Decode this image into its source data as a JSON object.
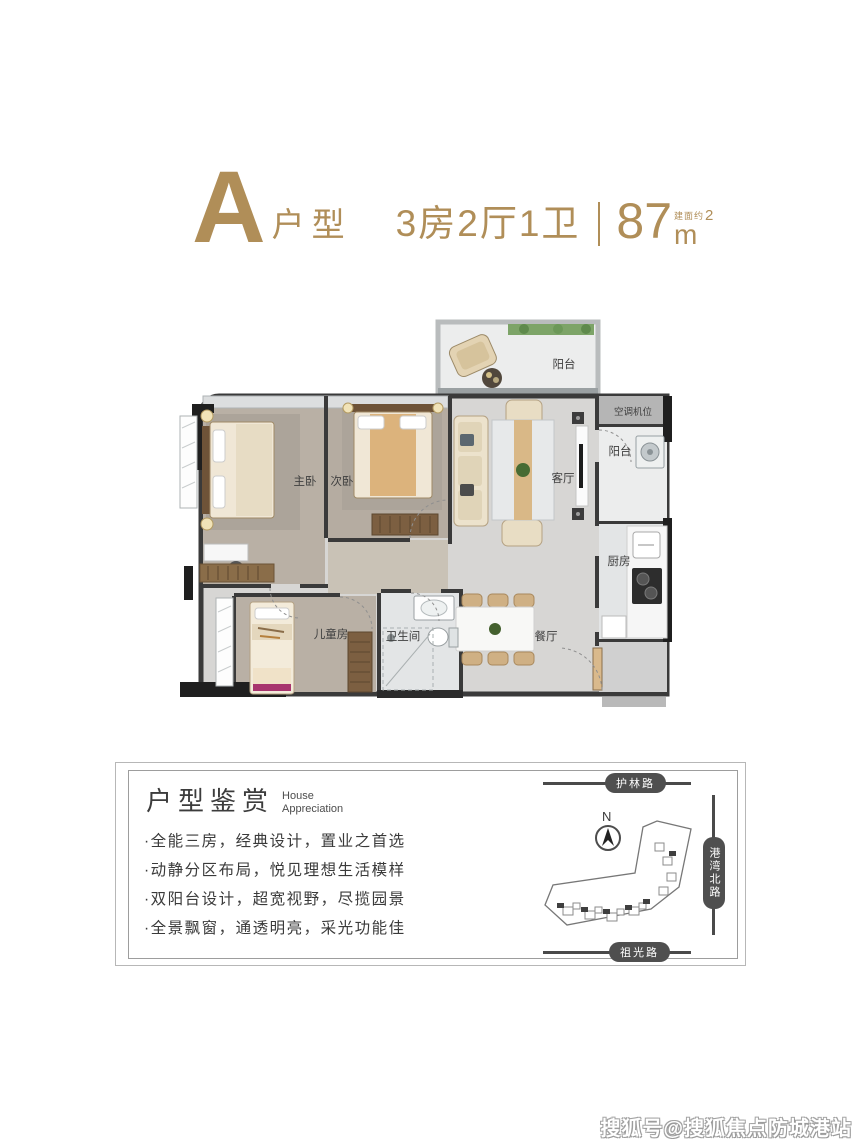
{
  "header": {
    "unit_letter": "A",
    "unit_type": "户型",
    "layout": "3房2厅1卫",
    "area_note": "建面约",
    "area_value": "87",
    "area_unit": "m",
    "area_sup": "2"
  },
  "floorplan": {
    "rooms": {
      "balcony_top": "阳台",
      "ac_unit": "空调机位",
      "balcony_side": "阳台",
      "master_bedroom": "主卧",
      "second_bedroom": "次卧",
      "living_room": "客厅",
      "kitchen": "厨房",
      "dining_room": "餐厅",
      "kids_room": "儿童房",
      "bathroom": "卫生间"
    }
  },
  "panel": {
    "title": "户型鉴赏",
    "subtitle_line1": "House",
    "subtitle_line2": "Appreciation",
    "bullets": [
      "·全能三房，经典设计，置业之首选",
      "·动静分区布局，悦见理想生活模样",
      "·双阳台设计，超宽视野，尽揽园景",
      "·全景飘窗，通透明亮，采光功能佳"
    ]
  },
  "map": {
    "compass": "N",
    "roads": {
      "top": "护林路",
      "right": "港湾北路",
      "bottom": "祖光路"
    }
  },
  "watermark": "搜狐号@搜狐焦点防城港站",
  "colors": {
    "accent_gold": "#b08e58",
    "wall": "#3a3a3a",
    "road_capsule": "#4f4f4f"
  }
}
